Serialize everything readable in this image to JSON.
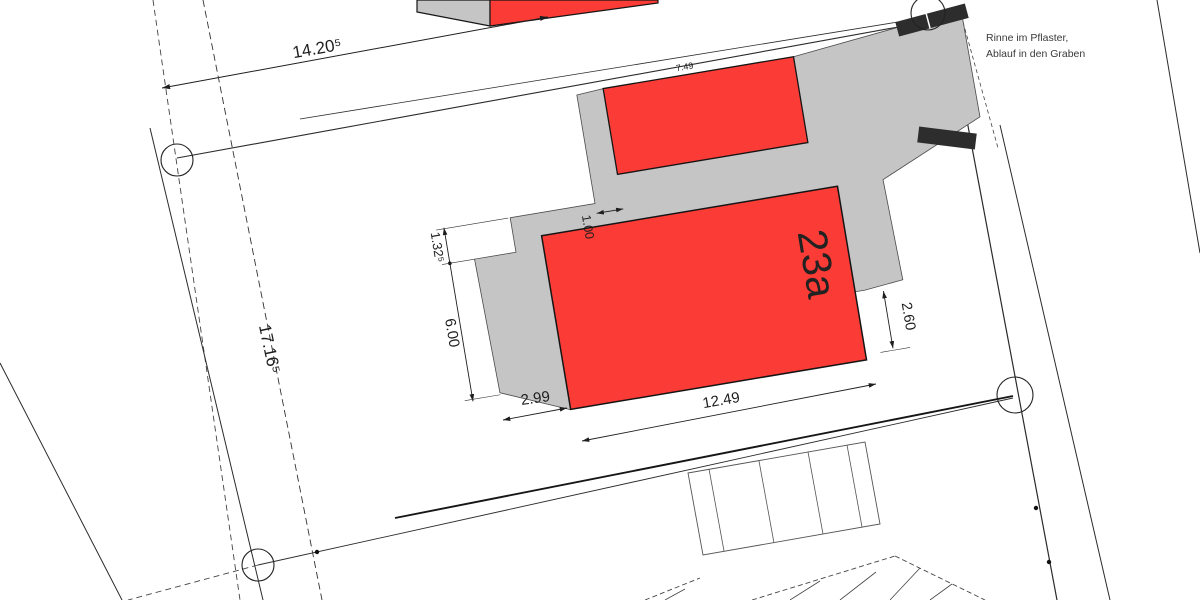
{
  "plan": {
    "title": "Lageplan",
    "labels": {
      "building": "23a"
    },
    "note": {
      "line1": "Rinne im Pflaster,",
      "line2": "Ablauf in den Graben"
    },
    "dimensions": {
      "plot_top": "14.20⁵",
      "plot_left": "17.16⁵",
      "step": "1.32⁵",
      "left_edge": "6.00",
      "strip": "1.00",
      "bottom_left": "2.99",
      "building_length": "12.49",
      "right_offset": "2.60",
      "garage_width": "7.49"
    },
    "colors": {
      "building": "#fb3b35",
      "pavement": "#c5c5c5",
      "wall": "#2d2d2d",
      "line": "#222222"
    }
  }
}
